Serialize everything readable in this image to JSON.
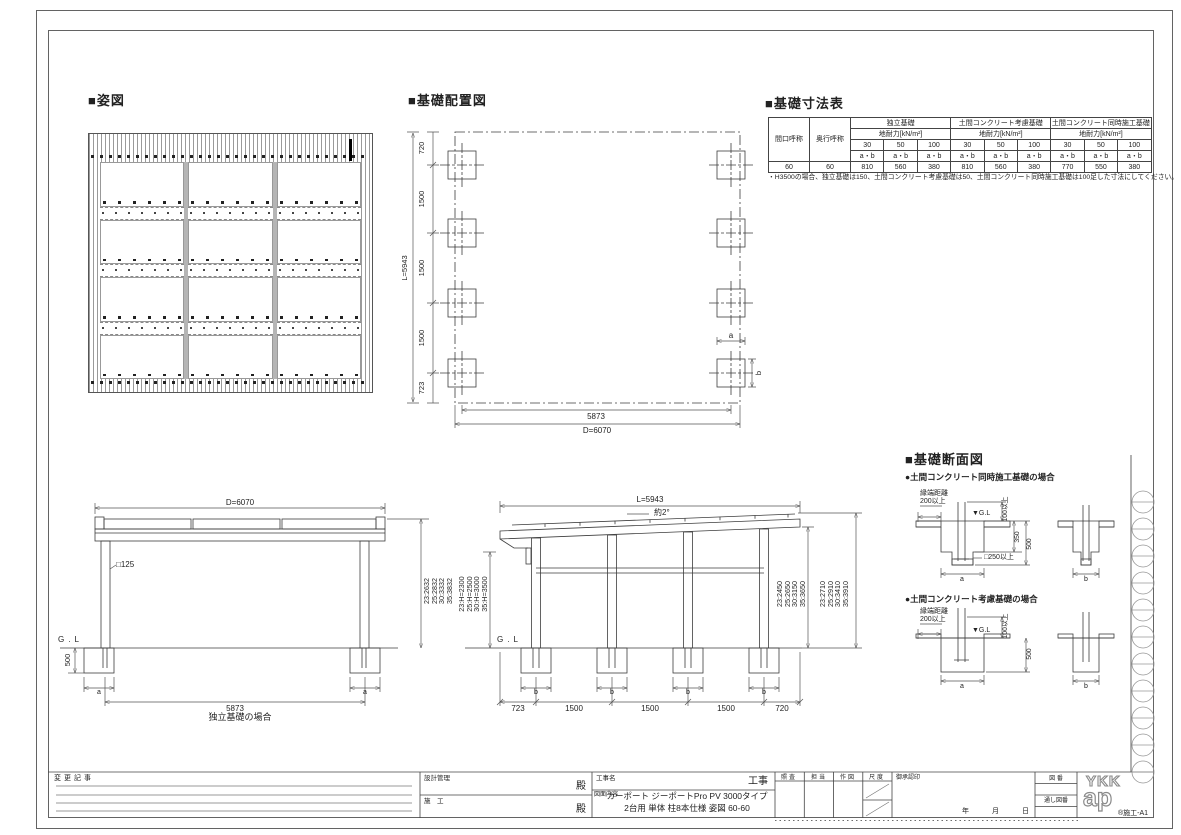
{
  "plan": {
    "title": "■姿図"
  },
  "layout": {
    "title": "■基礎配置図",
    "v_total": "L=5943",
    "v_dims": [
      "720",
      "1500",
      "1500",
      "1500",
      "723"
    ],
    "h_inner": "5873",
    "h_total": "D=6070",
    "label_a": "a",
    "label_b": "b"
  },
  "table": {
    "title": "■基礎寸法表",
    "head_col1": "間口呼称",
    "head_col2": "奥行呼称",
    "groups": [
      "独立基礎",
      "土間コンクリート考慮基礎",
      "土間コンクリート同時施工基礎"
    ],
    "load_header": "地耐力[kN/m²]",
    "loads": [
      "30",
      "50",
      "100"
    ],
    "ab": "a・b",
    "values": [
      "60",
      "60",
      "810",
      "560",
      "380",
      "810",
      "560",
      "380",
      "770",
      "550",
      "380"
    ],
    "note": "・H3500の場合、独立基礎は150、土間コンクリート考慮基礎は50、土間コンクリート同時施工基礎は100足した寸法にしてください。"
  },
  "front": {
    "top_dim": "D=6070",
    "post_label": "□125",
    "gl": "G.L",
    "depth": "500",
    "foot_dim": "a",
    "span_dim": "5873",
    "caption": "独立基礎の場合",
    "heights": [
      "23:2632",
      "25:2832",
      "30:3332",
      "35:3832"
    ]
  },
  "side": {
    "top_dim": "L=5943",
    "slope": "約2°",
    "eave_heights": [
      "23:H=2300",
      "25:H=2500",
      "30:H=3000",
      "35:H=3500"
    ],
    "right_inner": [
      "23:2450",
      "25:2650",
      "30:3150",
      "35:3650"
    ],
    "right_outer": [
      "23:2710",
      "25:2910",
      "30:3410",
      "35:3910"
    ],
    "gl": "G.L",
    "foot_dim": "b",
    "bottom_dims": [
      "723",
      "1500",
      "1500",
      "1500",
      "720"
    ]
  },
  "section": {
    "title": "■基礎断面図",
    "case1": "●土間コンクリート同時施工基礎の場合",
    "case2": "●土間コンクリート考慮基礎の場合",
    "edge1": "縁端距離",
    "edge2": "200以上",
    "gl": "▼G.L",
    "d100": "100以上",
    "d350": "350",
    "d500": "500",
    "pocket": "□250以上",
    "a": "a",
    "b": "b"
  },
  "titleblock": {
    "change": "変更記事",
    "design": "設計管理",
    "constr": "施　工",
    "dono": "殿",
    "project_label": "工事名",
    "project": "工事",
    "content_label": "図面内容",
    "content_line1": "カーポート ジーポートPro PV 3000タイプ",
    "content_line2": "2台用 単体 柱8本仕様 姿図 60-60",
    "cols": [
      "照査",
      "担当",
      "作図",
      "尺度"
    ],
    "approval": "御承認印",
    "date": [
      "年",
      "月",
      "日"
    ],
    "zuban": "図 番",
    "tooshi": "通し図番",
    "logo1": "YKK",
    "logo2": "ap",
    "code": "®施工-A1"
  }
}
